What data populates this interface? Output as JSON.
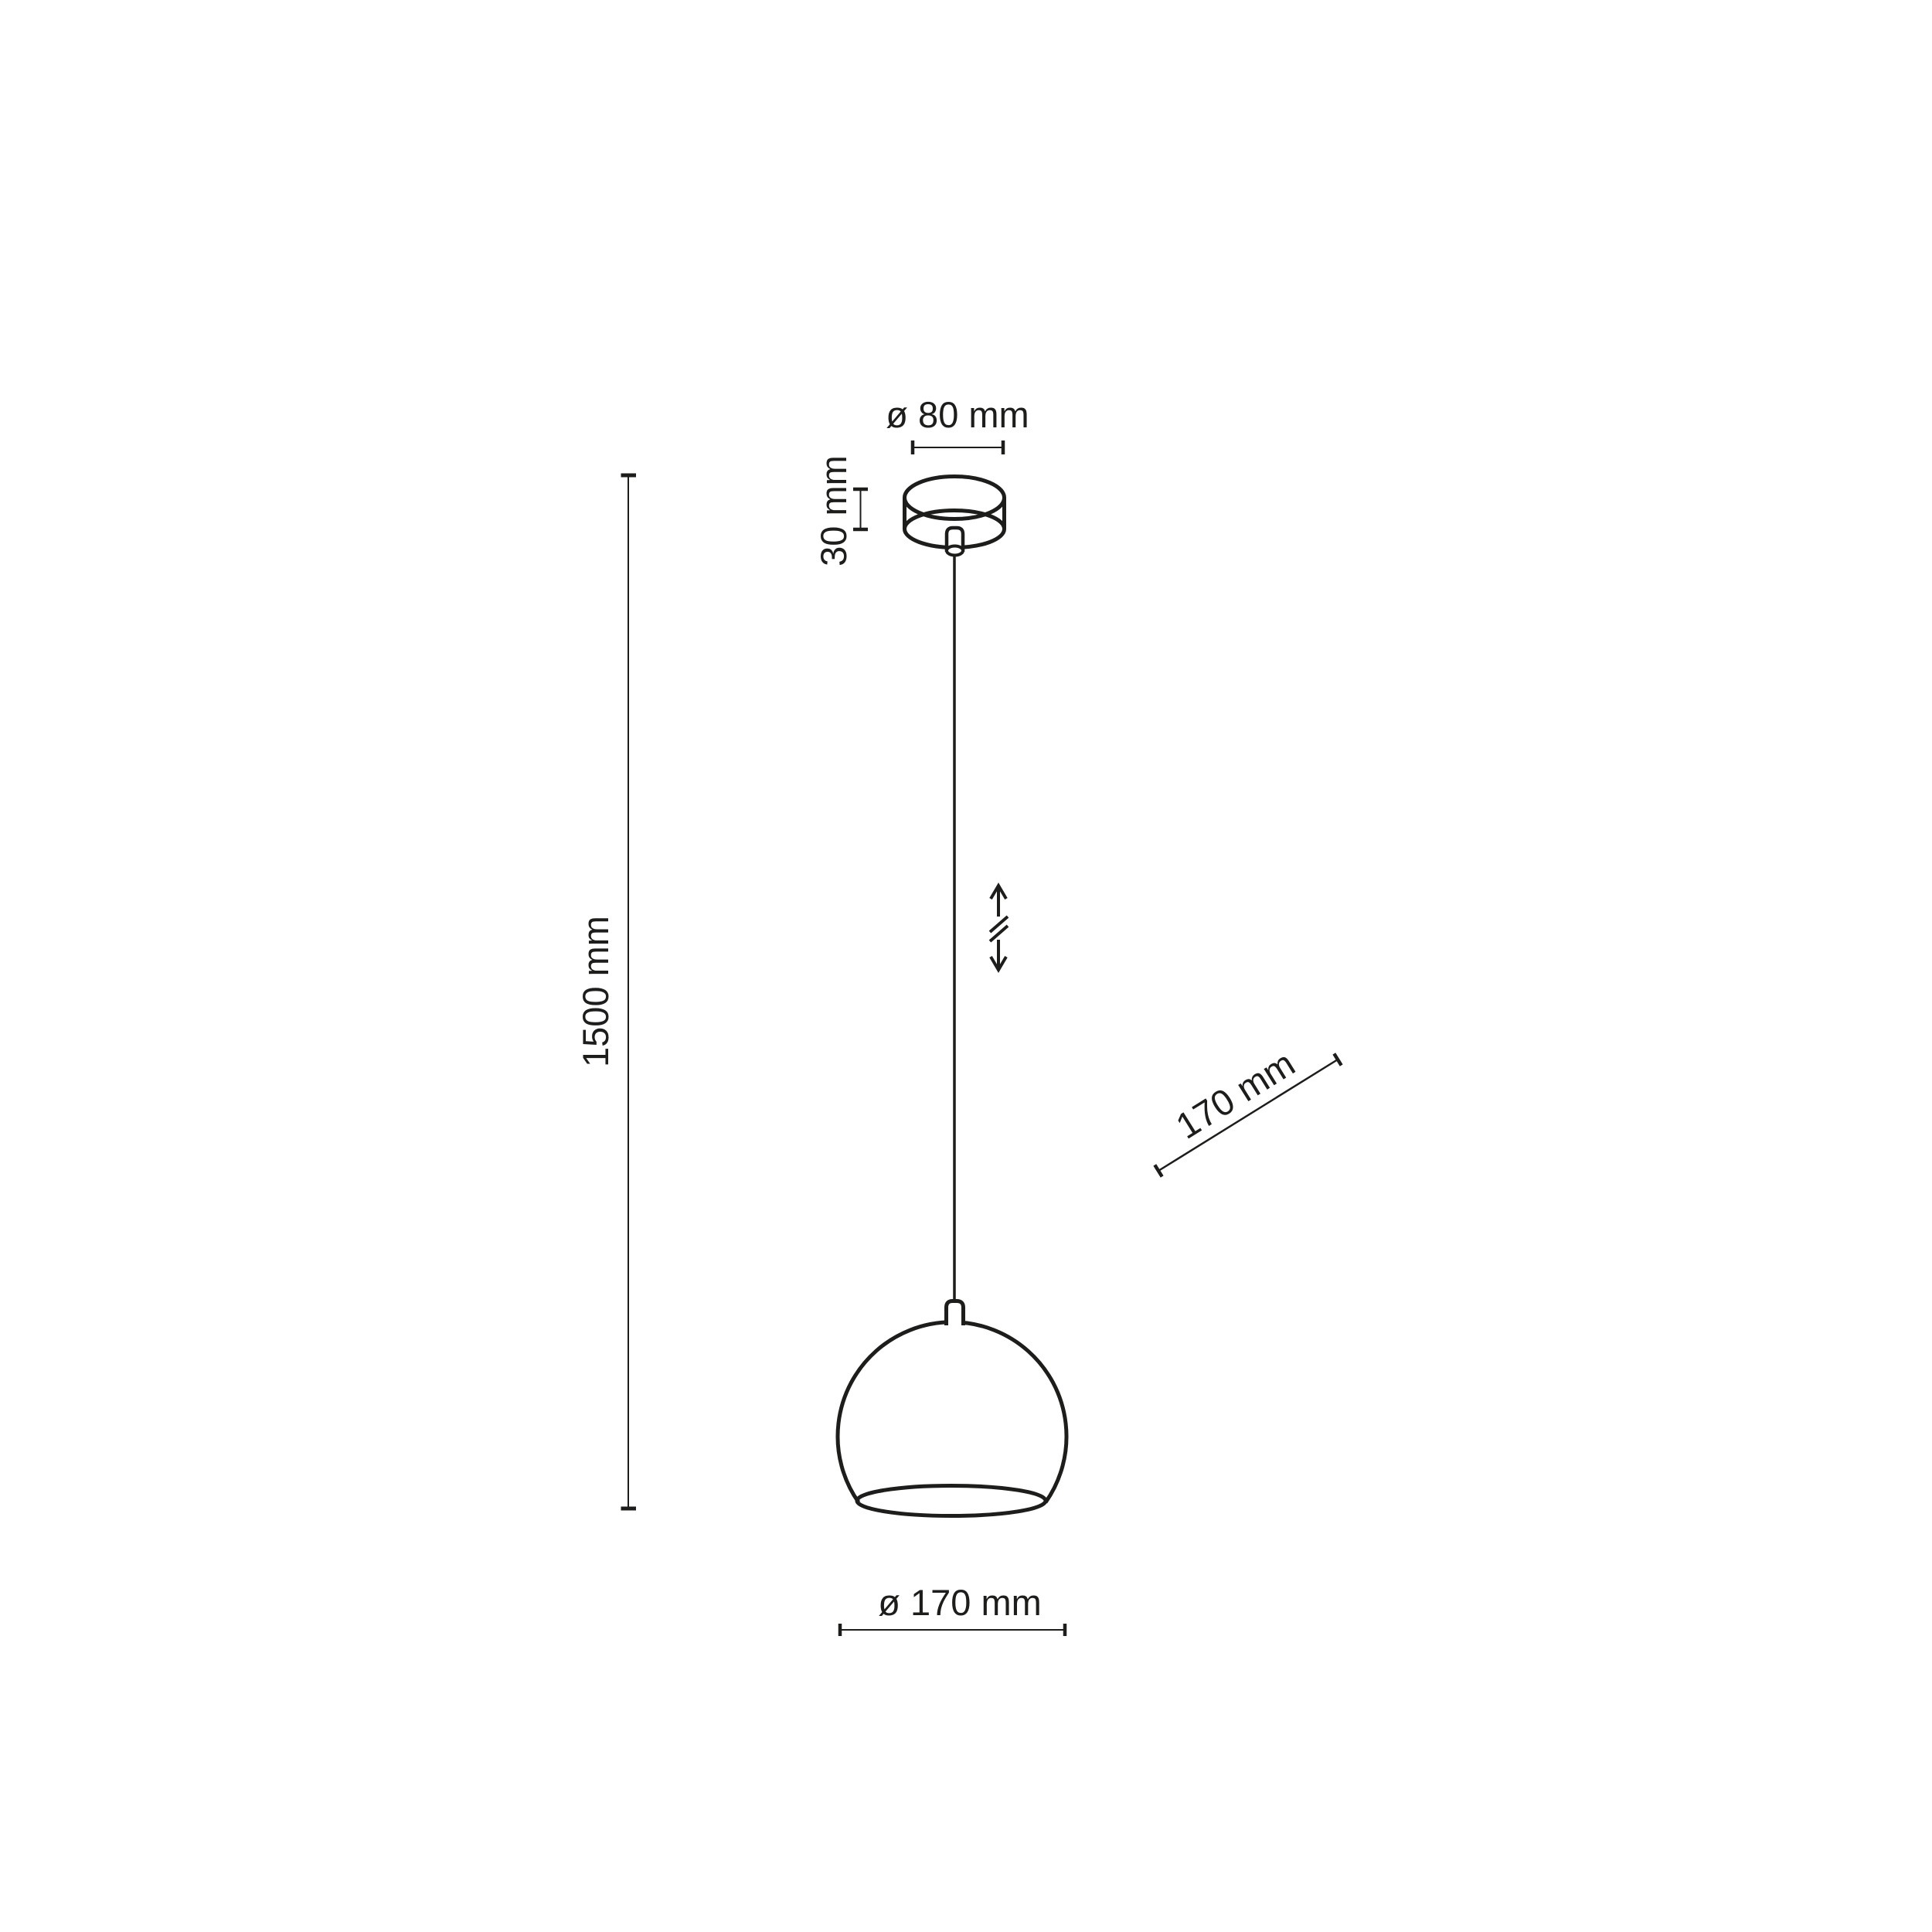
{
  "drawing": {
    "type": "technical-dimension-drawing",
    "subject": "pendant-lamp",
    "background_color": "#ffffff",
    "line_color": "#1d1d1b",
    "labels": {
      "canopy_diameter": "ø 80 mm",
      "canopy_height": "30 mm",
      "suspension_length": "1500 mm",
      "shade_diagonal": "170 mm",
      "shade_diameter": "ø 170 mm"
    },
    "icons": {
      "height_adjustment": "double-vertical-arrow-with-break-icon"
    }
  }
}
